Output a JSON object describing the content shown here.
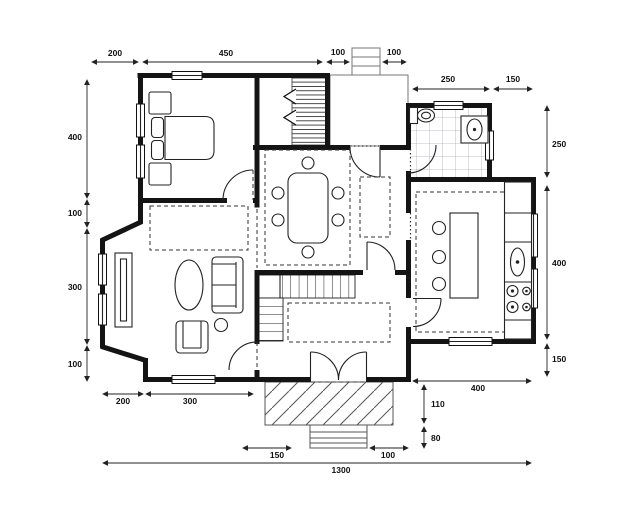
{
  "drawing": {
    "kind": "house floor plan",
    "background": "#ffffff",
    "wall_color": "#141414",
    "hatch_color": "#555555",
    "tile_color": "#a8aeb6"
  },
  "dimensions": {
    "top": [
      "200",
      "450",
      "100",
      "100"
    ],
    "upper_right": [
      "250",
      "150"
    ],
    "left": [
      "400",
      "100",
      "300",
      "100"
    ],
    "right": [
      "250",
      "400",
      "150"
    ],
    "bottom_left": [
      "200",
      "300"
    ],
    "bottom_right": [
      "400"
    ],
    "porch_right": [
      "110",
      "80"
    ],
    "bottom": [
      "150",
      "100"
    ],
    "overall": "1300"
  }
}
